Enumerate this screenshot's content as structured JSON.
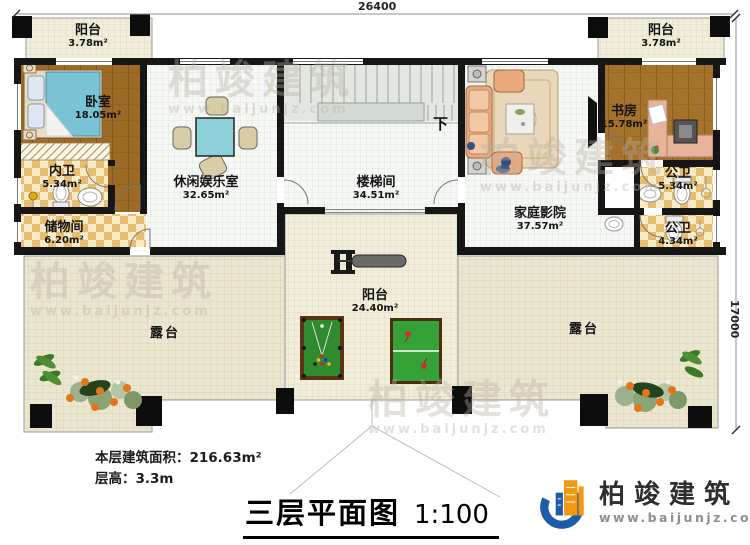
{
  "document": {
    "title": "三层平面图",
    "scale": "1:100"
  },
  "notes": {
    "floor_area_label": "本层建筑面积：",
    "floor_area_value": "216.63m²",
    "floor_height_label": "层高：",
    "floor_height_value": "3.3m"
  },
  "dimensions": {
    "width_top": "26400",
    "height_right": "17000"
  },
  "stairs": {
    "down_label": "下"
  },
  "rooms": {
    "balcony_tl": {
      "name": "阳台",
      "area": "3.78m²"
    },
    "balcony_tr": {
      "name": "阳台",
      "area": "3.78m²"
    },
    "bedroom": {
      "name": "卧室",
      "area": "18.05m²"
    },
    "ensuite_bath": {
      "name": "内卫",
      "area": "5.34m²"
    },
    "storage": {
      "name": "储物间",
      "area": "6.20m²"
    },
    "leisure_room": {
      "name": "休闲娱乐室",
      "area": "32.65m²"
    },
    "stairwell": {
      "name": "楼梯间",
      "area": "34.51m²"
    },
    "home_theater": {
      "name": "家庭影院",
      "area": "37.57m²"
    },
    "study": {
      "name": "书房",
      "area": "15.78m²"
    },
    "public_bath_upper": {
      "name": "公卫",
      "area": "5.34m²"
    },
    "public_bath_lower": {
      "name": "公卫",
      "area": "4.34m²"
    },
    "balcony_center": {
      "name": "阳台",
      "area": "24.40m²"
    },
    "terrace_left": {
      "name": "露台"
    },
    "terrace_right": {
      "name": "露台"
    }
  },
  "branding": {
    "company": "柏竣建筑",
    "website": "www.baijunjz.com"
  },
  "watermark": {
    "company": "柏竣建筑",
    "website": "www.baijunjz.com"
  },
  "colors": {
    "wall": "#161616",
    "wood_floor": "#a5722c",
    "checker_tile": "#e7bd72",
    "terrace_floor": "#ebe6d0",
    "table_teal": "#8ed0d8",
    "billiard_green": "#2e8b2e",
    "brand_blue": "#1c5ca8",
    "brand_orange": "#f2990f"
  }
}
